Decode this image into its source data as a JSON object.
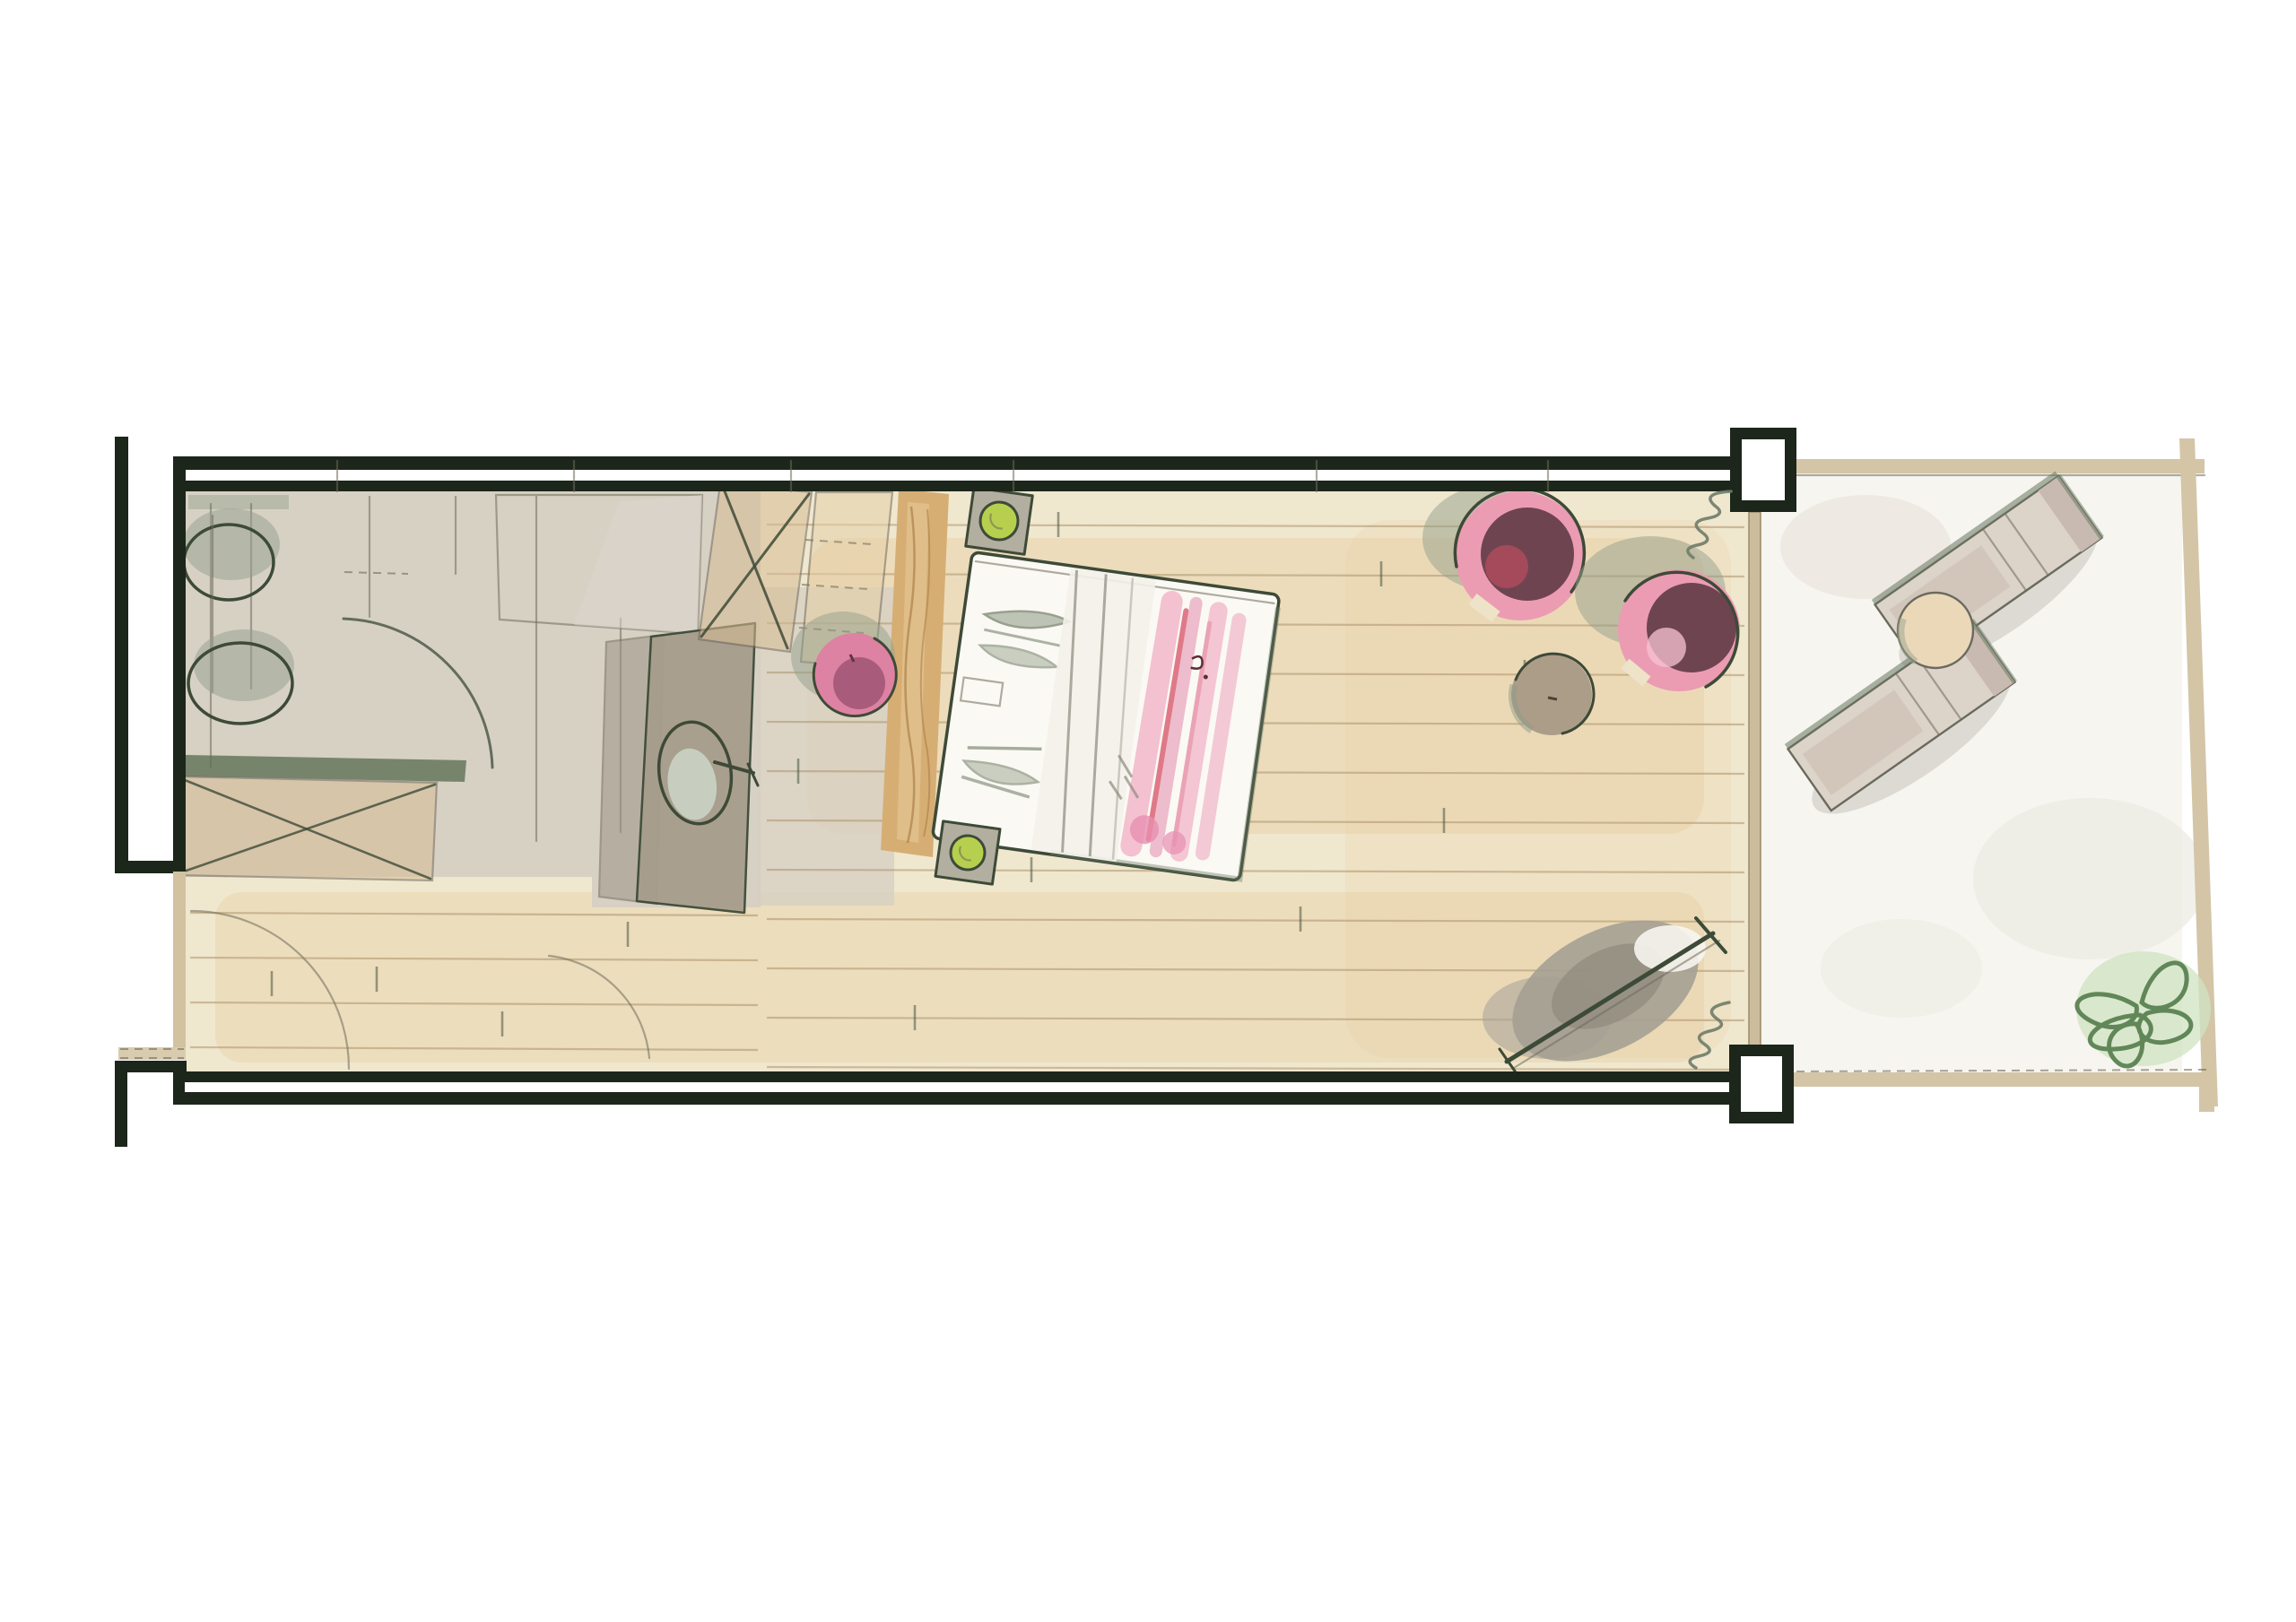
{
  "plan": {
    "style": "hand-drawn watercolor floor plan sketch",
    "areas": [
      {
        "name": "bathroom",
        "items": [
          "toilet",
          "bidet",
          "shower",
          "vanity-with-sink",
          "storage-bench"
        ]
      },
      {
        "name": "entry-hall",
        "items": [
          "entry-door",
          "interior-door",
          "wood-floor"
        ]
      },
      {
        "name": "bedroom",
        "items": [
          "wardrobe",
          "headboard-panel",
          "double-bed",
          "nightstand-with-lamp-top",
          "nightstand-with-lamp-bottom",
          "pink-pouf",
          "round-armchair-1",
          "round-armchair-2",
          "side-table",
          "tv-console",
          "curtain-top",
          "curtain-bottom"
        ]
      },
      {
        "name": "terrace",
        "items": [
          "sun-lounger-1",
          "sun-lounger-2",
          "lounger-table",
          "potted-plant"
        ]
      }
    ],
    "structure": [
      "corridor-wall",
      "room-walls",
      "pillar-top-right",
      "pillar-bottom-right",
      "glass-divider",
      "terrace-border"
    ]
  },
  "palette": {
    "paper": "#ffffff",
    "wall_ink": "#1c261b",
    "pencil": "#70695a",
    "sketch_ink": "#3d4a37",
    "floor_wood": "#f0e7cf",
    "floor_wood_warm": "#e7cfa3",
    "plank_line": "#a88d63",
    "bath_floor": "#d6cfc3",
    "gray_wash": "#dad6cd",
    "tan_furniture": "#d8bd94",
    "tan_light": "#e5d1a8",
    "headboard_wood": "#d6ae74",
    "gray_partition": "#9c9485",
    "counter_taupe": "#a79d8c",
    "sink_mint": "#d4e3d6",
    "green_band": "#5f7156",
    "lamp_green": "#b7cf4e",
    "pink_ring": "#eb9cb3",
    "pink_highlight": "#f7c3d1",
    "plum_seat": "#6f4451",
    "red_accent": "#c84f62",
    "stripe_pink": "#f2b4c8",
    "stripe_red": "#d95a6e",
    "shadow_green": "#93a08b",
    "stool_pink": "#dd82a2",
    "stool_plum": "#a05574",
    "terrace_border": "#d3c5a6",
    "terrace_floor": "#f6f5f0",
    "lounger_fill": "#dcd3c9",
    "lounger_pad": "#c8bab0",
    "plant_green": "#537c4b",
    "plant_wash": "#cfe3c2",
    "table_taupe": "#ac9d89",
    "curtain": "#6e7c69",
    "mattress": "#fbf9f4",
    "nightstand_gray": "#b2aea0"
  }
}
